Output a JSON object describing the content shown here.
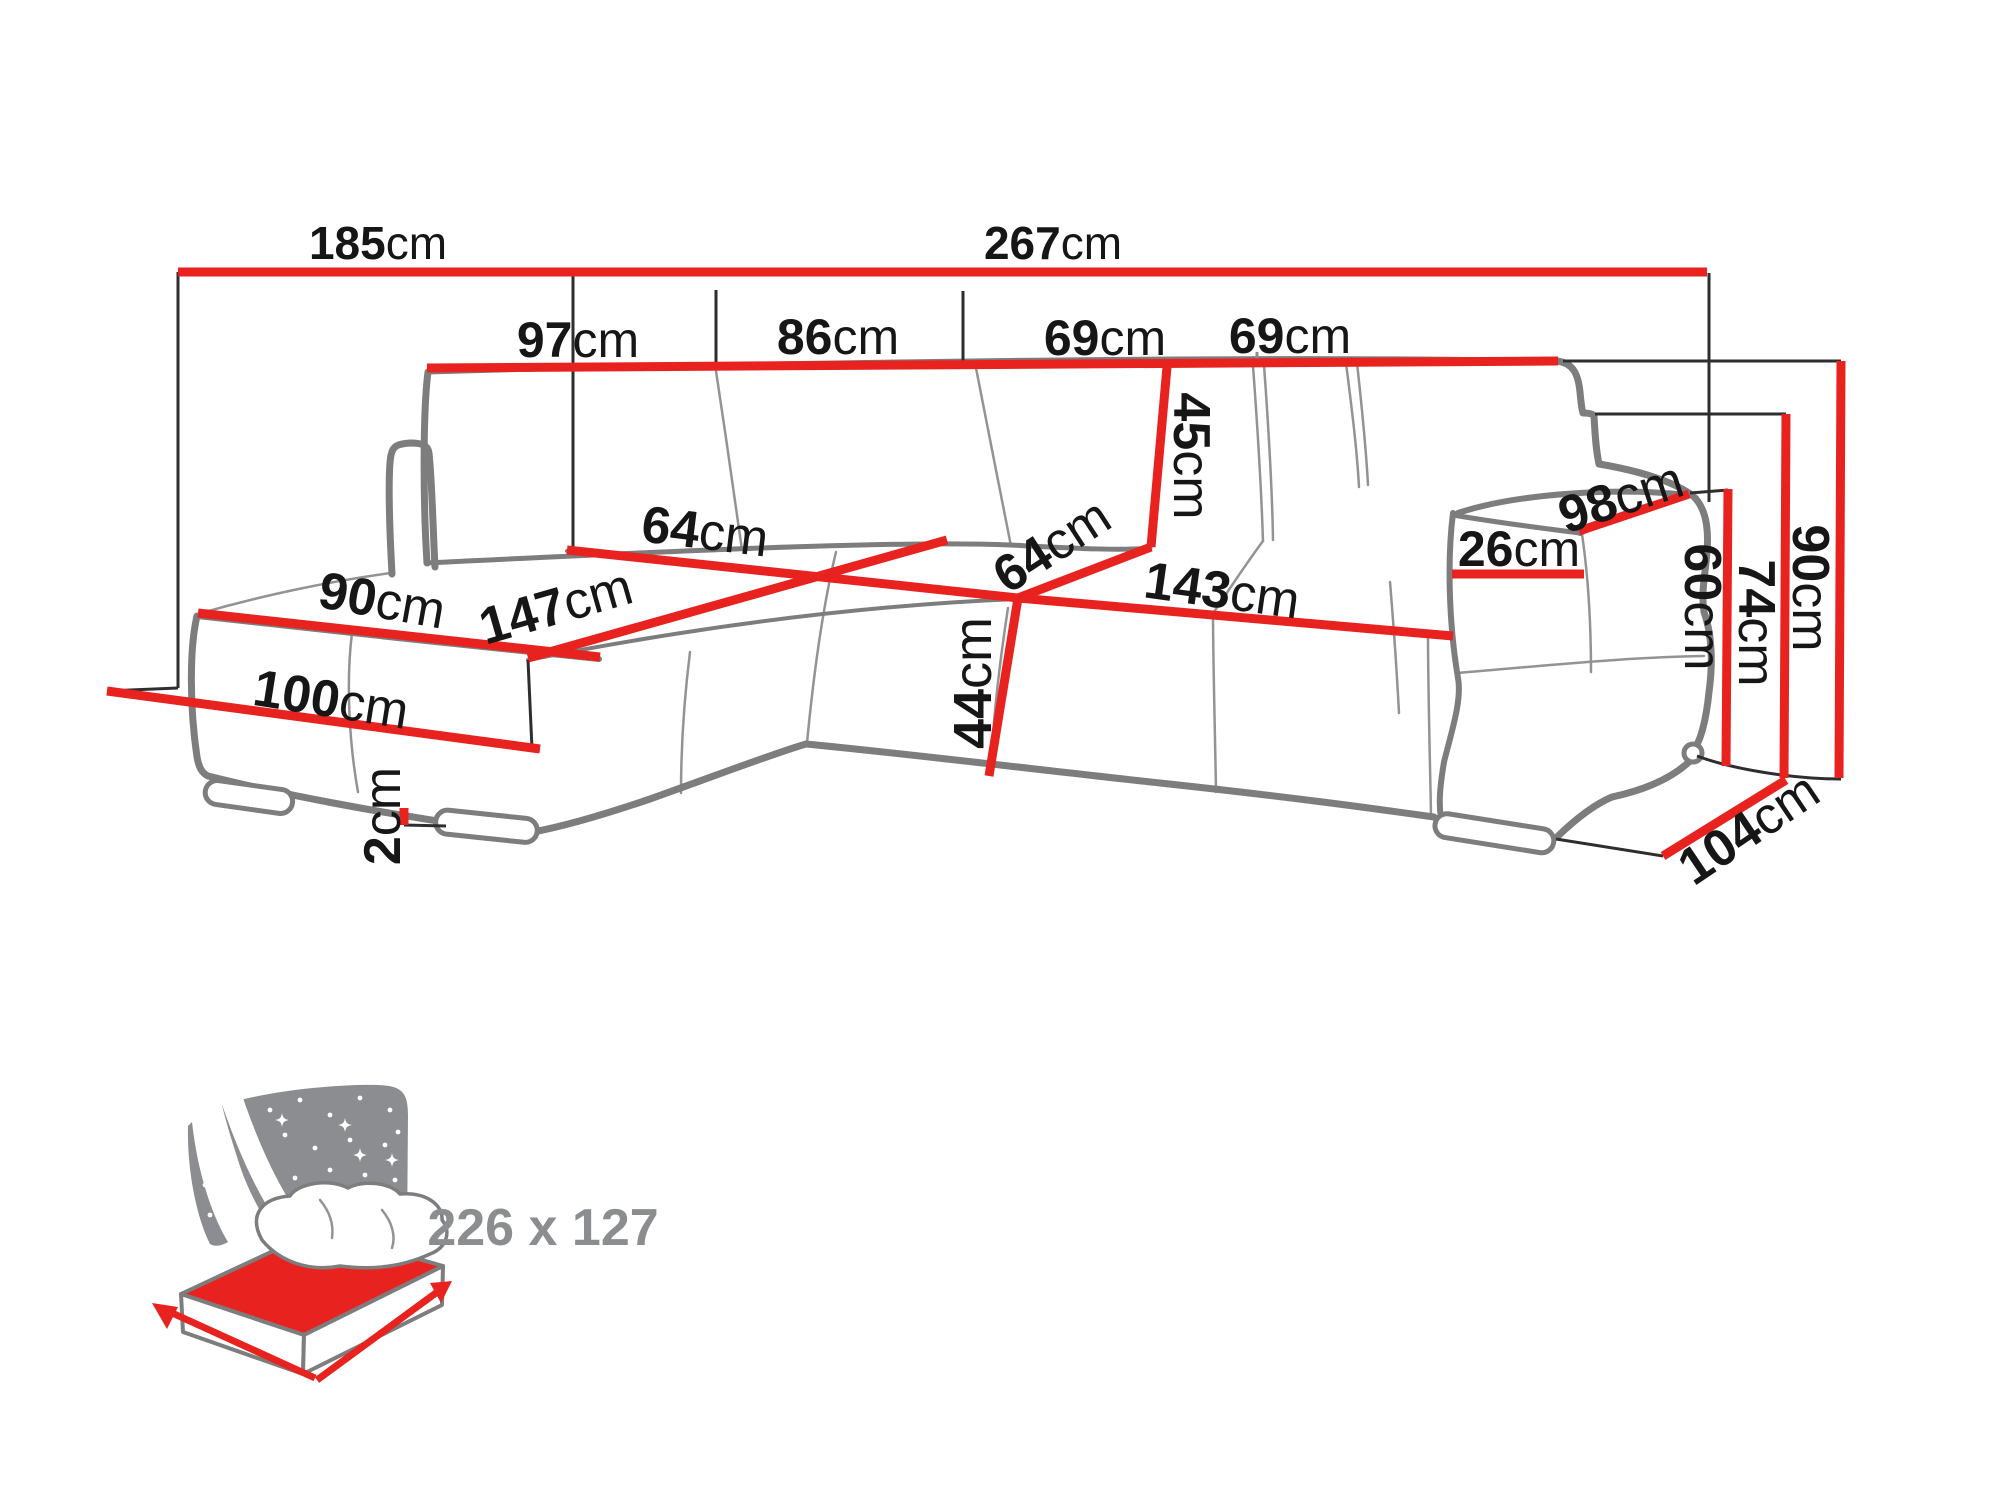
{
  "diagram": {
    "type": "corner-sofa-dimension-diagram",
    "unit_suffix": "cm",
    "colors": {
      "dimension_red": "#e8231f",
      "sketch_gray": "#7d7d7d",
      "icon_gray": "#8b8d90",
      "label_black": "#161616"
    },
    "icons": {
      "sleeping_function": "bed-with-starry-headboard-icon"
    },
    "dims": {
      "total_left": {
        "value": "185",
        "unit": "cm"
      },
      "total_right": {
        "value": "267",
        "unit": "cm"
      },
      "back_sec_1": {
        "value": "97",
        "unit": "cm"
      },
      "back_sec_2": {
        "value": "86",
        "unit": "cm"
      },
      "back_sec_3": {
        "value": "69",
        "unit": "cm"
      },
      "back_sec_4": {
        "value": "69",
        "unit": "cm"
      },
      "backrest_h": {
        "value": "45",
        "unit": "cm"
      },
      "seat_depth_l": {
        "value": "64",
        "unit": "cm"
      },
      "seat_depth_r": {
        "value": "64",
        "unit": "cm"
      },
      "chaise_len": {
        "value": "147",
        "unit": "cm"
      },
      "seat_width": {
        "value": "143",
        "unit": "cm"
      },
      "chaise_width": {
        "value": "90",
        "unit": "cm"
      },
      "chaise_floor": {
        "value": "100",
        "unit": "cm"
      },
      "leg_height": {
        "value": "2",
        "unit": "cm"
      },
      "seat_height": {
        "value": "44",
        "unit": "cm"
      },
      "armrest_top": {
        "value": "26",
        "unit": "cm"
      },
      "armrest_len": {
        "value": "98",
        "unit": "cm"
      },
      "height_seat": {
        "value": "60",
        "unit": "cm"
      },
      "height_arm": {
        "value": "74",
        "unit": "cm"
      },
      "height_total": {
        "value": "90",
        "unit": "cm"
      },
      "depth_total": {
        "value": "104",
        "unit": "cm"
      }
    },
    "sleeping_area": {
      "label": "226 x 127"
    }
  }
}
